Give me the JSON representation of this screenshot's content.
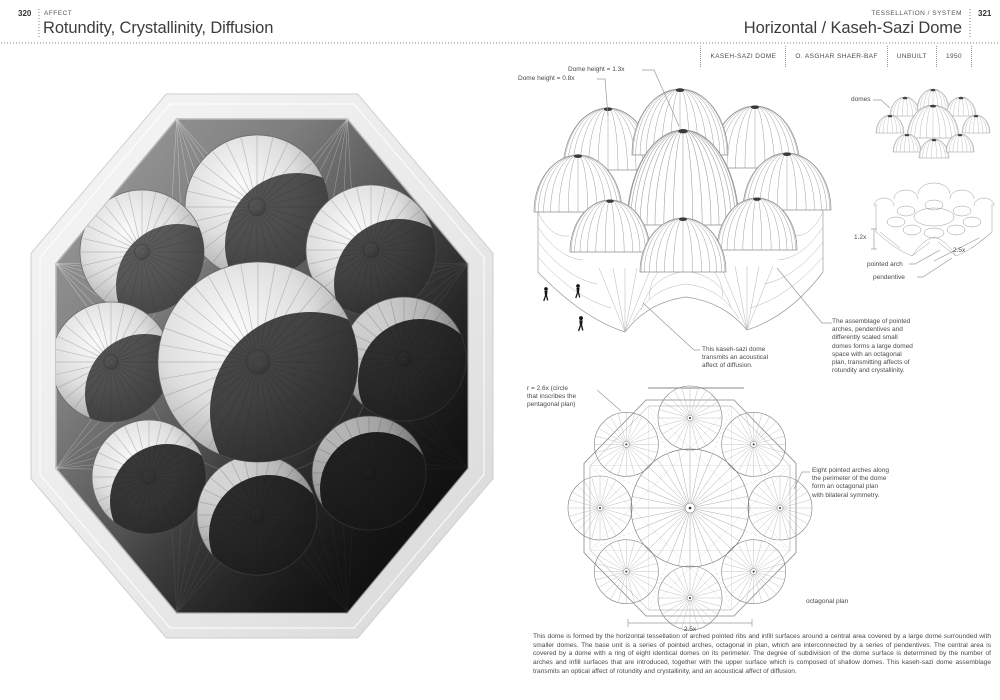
{
  "page": {
    "left": {
      "page_number": "320",
      "eyebrow": "AFFECT",
      "title": "Rotundity, Crystallinity, Diffusion"
    },
    "right": {
      "eyebrow": "TESSELLATION / SYSTEM",
      "page_number": "321",
      "title": "Horizontal / Kaseh-Sazi Dome",
      "meta": {
        "project": "KASEH-SAZI DOME",
        "architect": "O. ASGHAR SHAER-BAF",
        "status": "UNBUILT",
        "year": "1950"
      },
      "iso": {
        "label_height_large": "Dome height = 1.3x",
        "label_height_small": "Dome height = 0.8x",
        "caption": "This kaseh-sazi dome\ntransmits an acoustical\naffect of diffusion."
      },
      "side": {
        "label_domes": "domes",
        "dim_height": "1.2x",
        "dim_width": "2.5x",
        "label_pointed_arch": "pointed arch",
        "label_pendentive": "pendentive",
        "note": "The assemblage of pointed\narches, pendentives and\ndifferently scaled small\ndomes forms a large domed\nspace with an octagonal\nplan, transmitting affects of\nrotundity and crystallinity."
      },
      "plan": {
        "label_radius": "r = 2.6x (circle\nthat inscribes the\npentagonal plan)",
        "note": "Eight pointed arches along\nthe perimeter of the dome\nform an octagonal plan\nwith bilateral symmetry.",
        "label_plan": "octagonal plan",
        "dim_width": "2.5x"
      },
      "body": "This dome is formed by the horizontal tessellation of arched pointed ribs and infill surfaces around a central area covered by a large dome surrounded with smaller domes. The base unit is a series of pointed arches, octagonal in plan, which are interconnected by a series of pendentives. The central area is covered by a dome with a ring of eight identical domes on its perimeter. The degree of subdivision of the dome surface is determined by the number of arches and infill surfaces that are introduced, together with the upper surface which is composed of shallow domes. This kaseh-sazi dome assemblage transmits an optical affect of rotundity and crystallinity, and an acoustical affect of diffusion."
    }
  }
}
